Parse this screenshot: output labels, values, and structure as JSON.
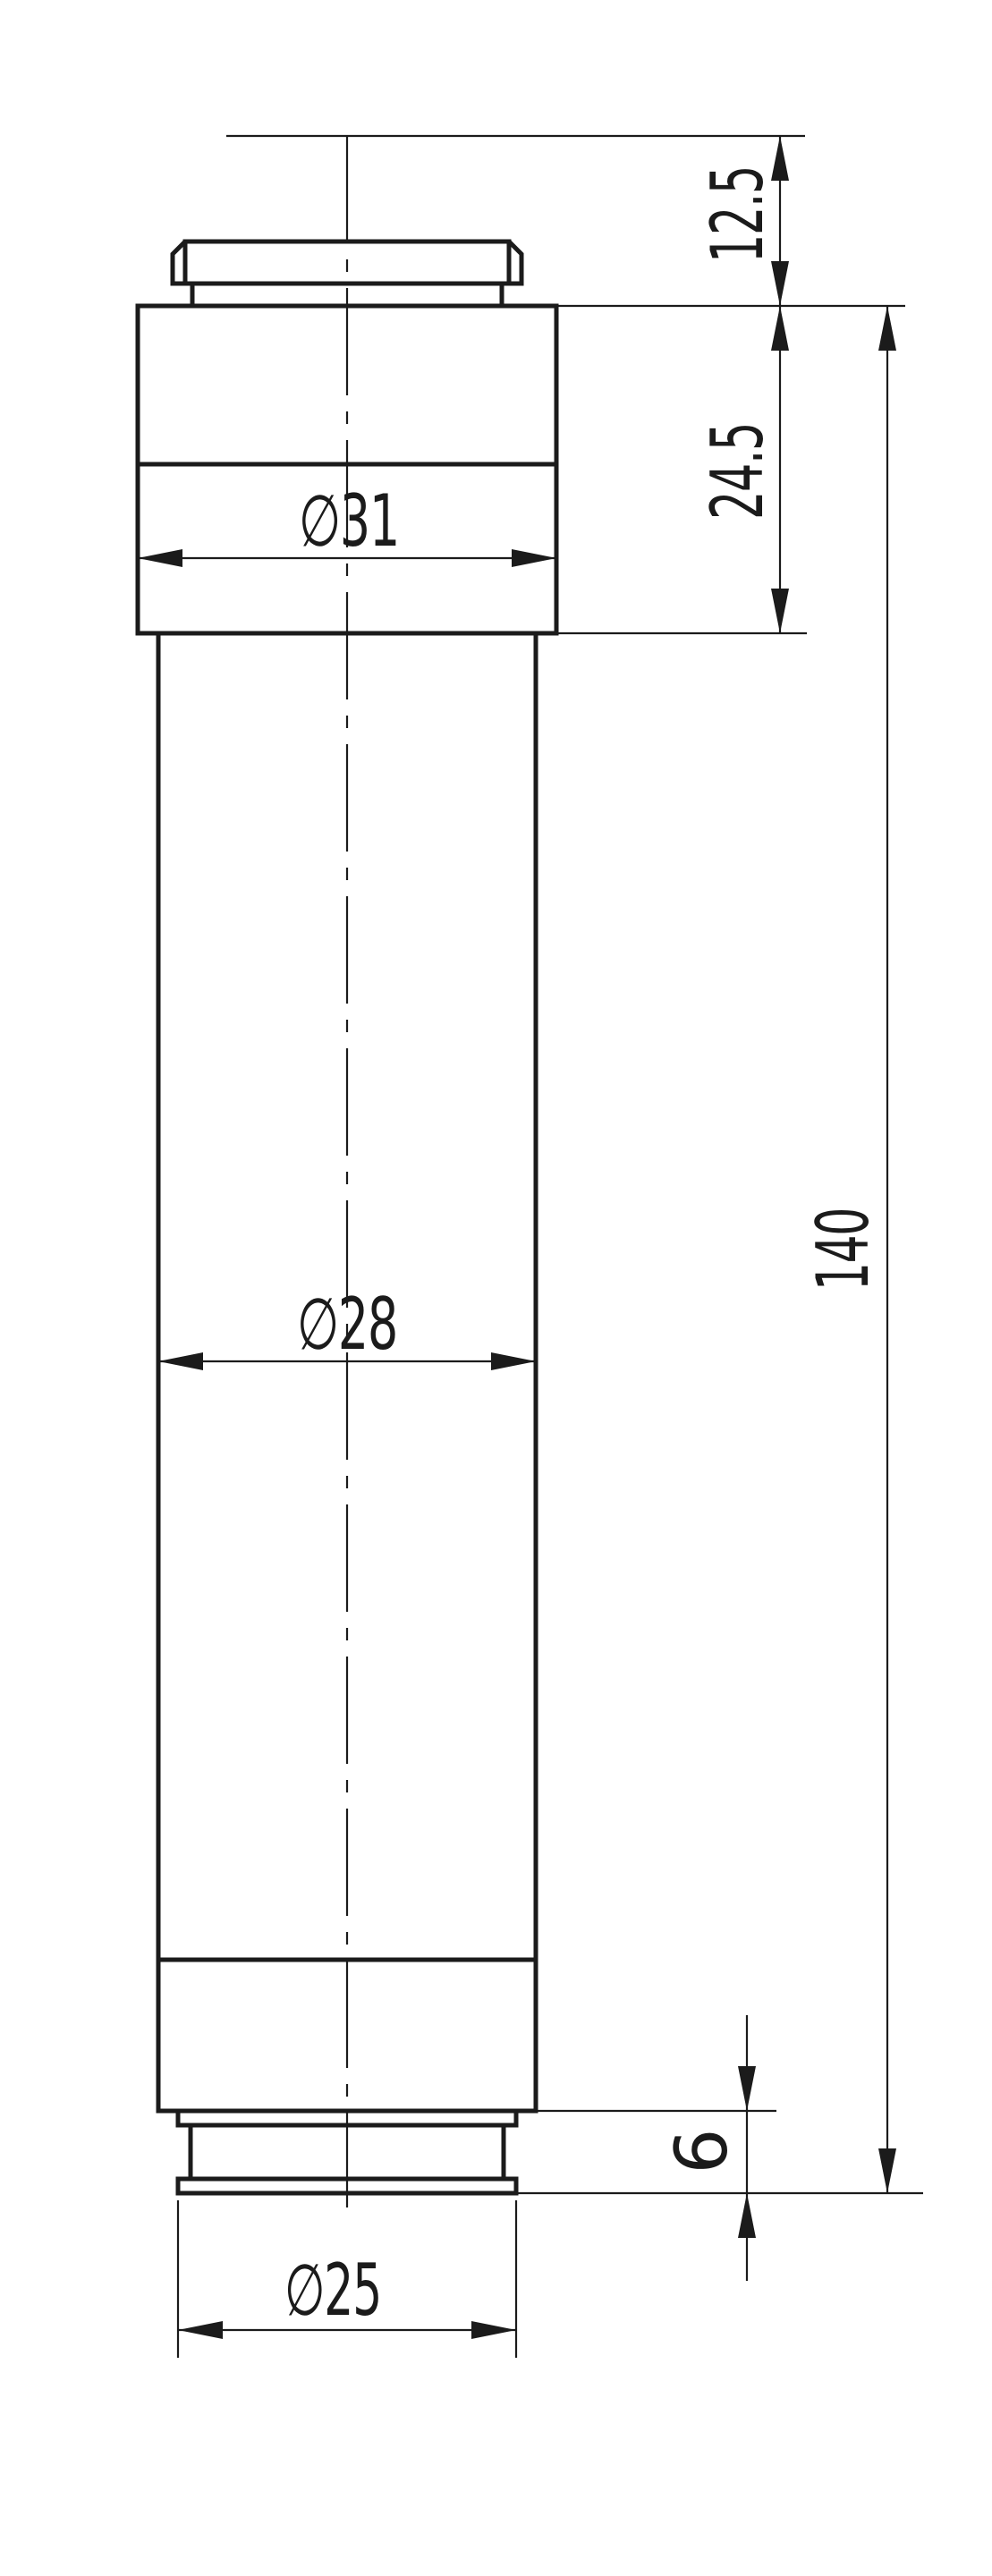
{
  "drawing": {
    "colors": {
      "line": "#1b1b1b",
      "background": "#ffffff"
    },
    "dimensions": {
      "cap_offset_height": {
        "label": "12.5",
        "value": 12.5
      },
      "head_section_height": {
        "label": "24.5",
        "value": 24.5
      },
      "overall_length": {
        "label": "140",
        "value": 140
      },
      "tail_step_height": {
        "label": "6",
        "value": 6
      },
      "head_diameter": {
        "label": "∅31",
        "value": 31
      },
      "body_diameter": {
        "label": "∅28",
        "value": 28
      },
      "tail_diameter": {
        "label": "∅25",
        "value": 25
      }
    }
  }
}
